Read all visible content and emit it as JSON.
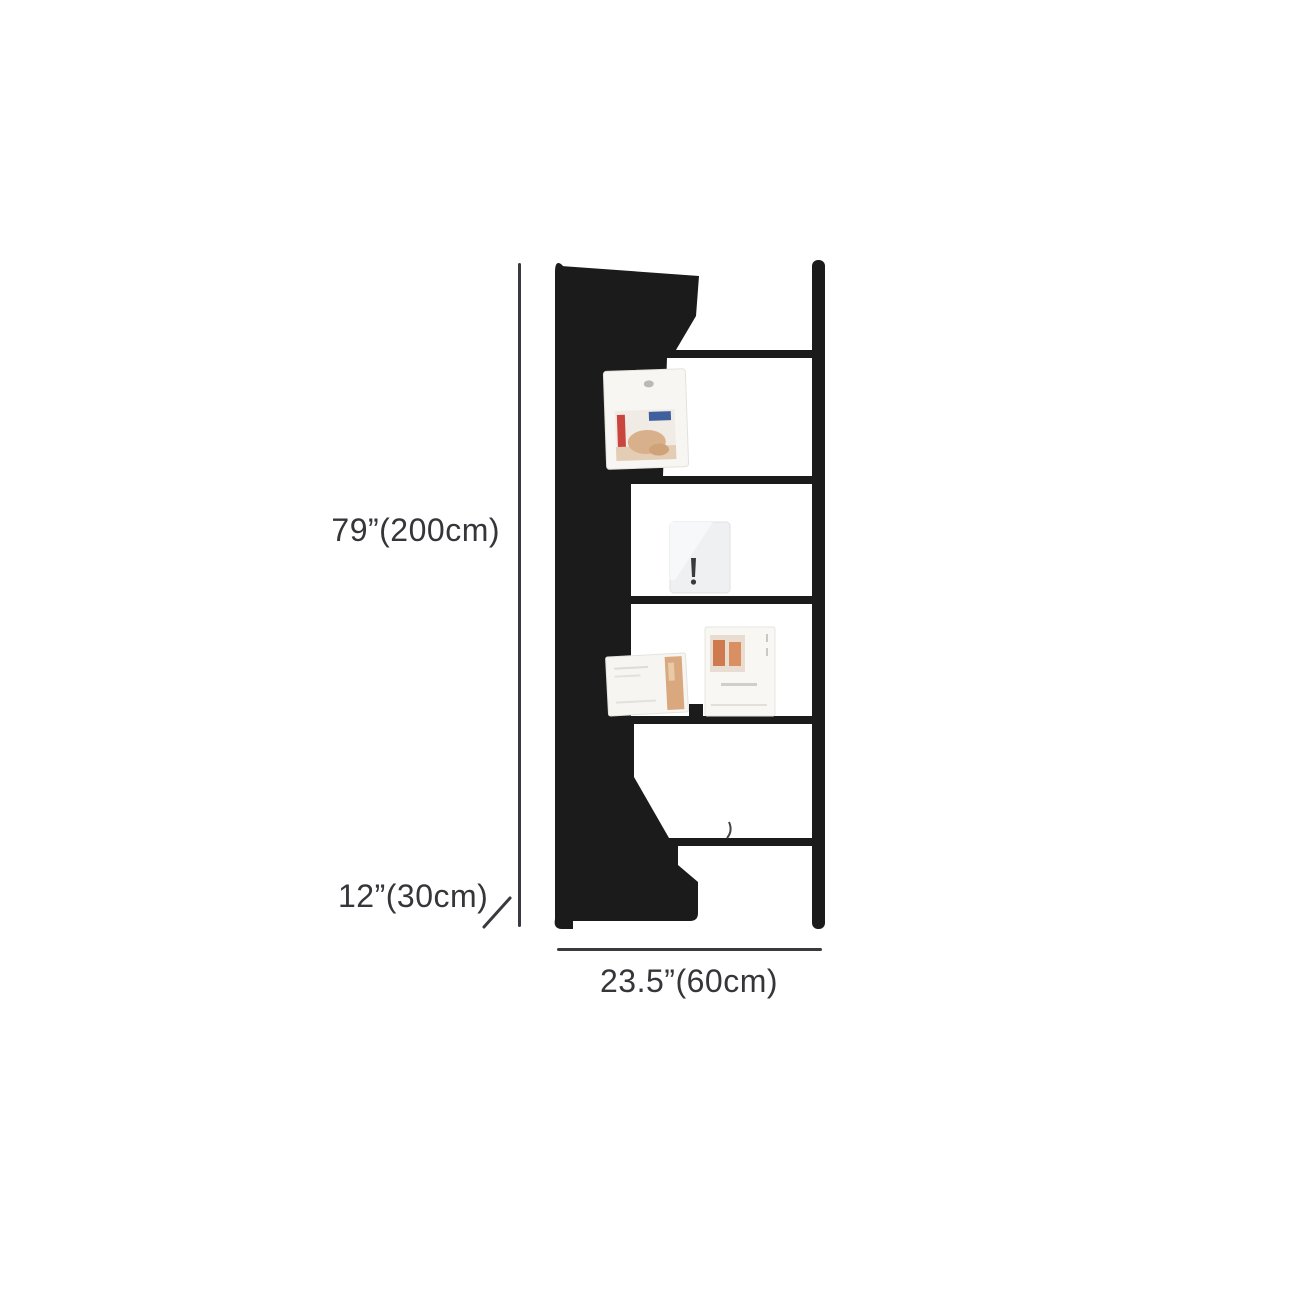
{
  "figure": {
    "type": "product-dimension-diagram",
    "subject": "tall black ladder bookshelf with magazines on shelves",
    "shelf_boards": 5,
    "open_sections": 6
  },
  "dimensions": {
    "height_label": "79”(200cm)",
    "depth_label": "12”(30cm)",
    "width_label": "23.5”(60cm)"
  },
  "colors": {
    "background": "#ffffff",
    "shelf": "#1b1b1b",
    "dimension_line": "#3a3a3e",
    "dimension_text": "#36363a",
    "magazine_white": "#f7f6f3",
    "board_gray": "#eef0f2",
    "photo_tan": "#d9a87e",
    "photo_red": "#c9453e",
    "photo_blue": "#3f5f9e"
  }
}
